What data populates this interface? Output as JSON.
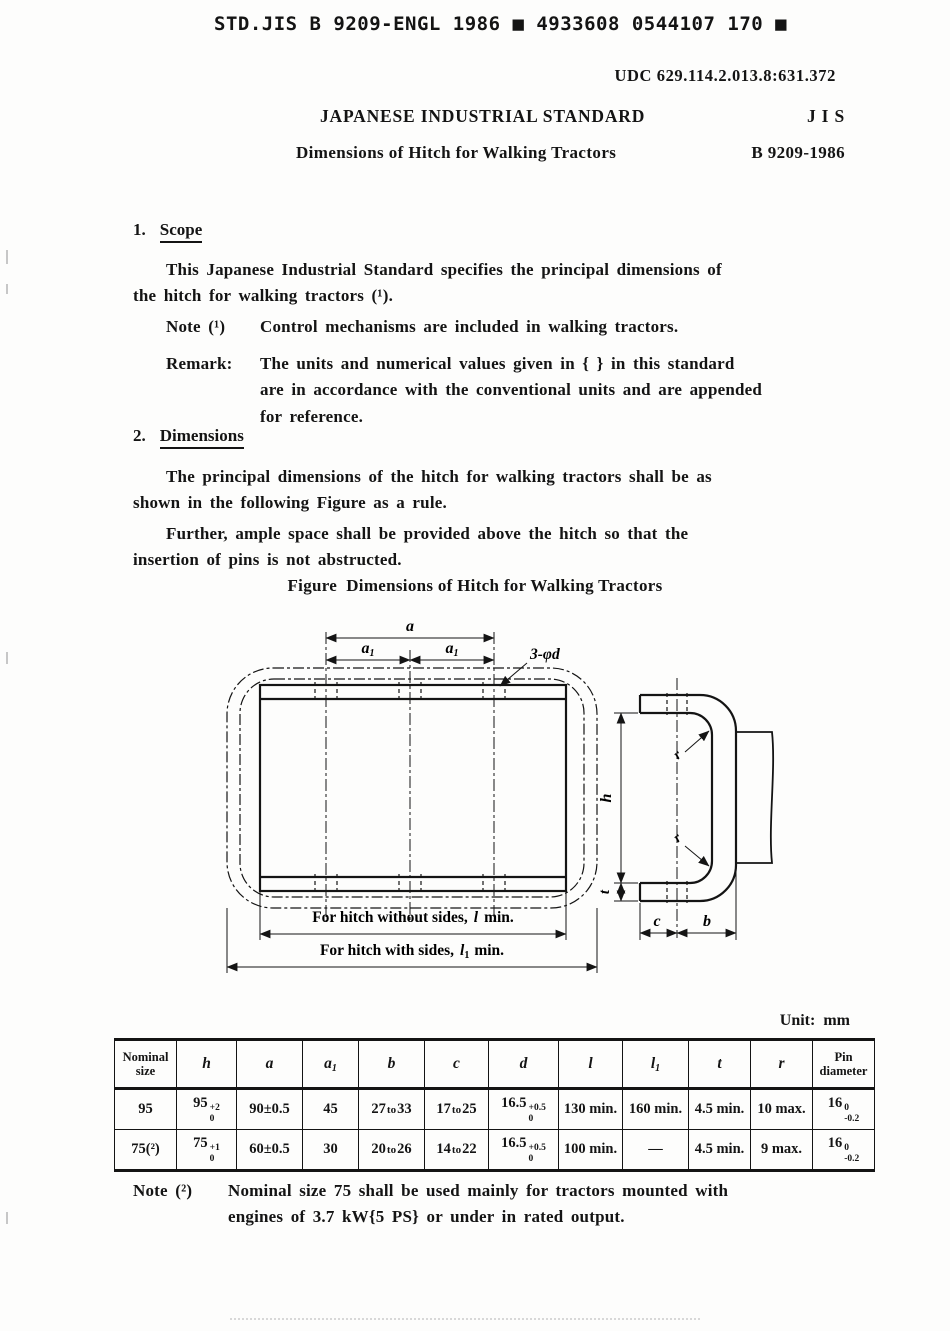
{
  "page": {
    "scan_header": "STD.JIS B 9209-ENGL 1986 ■ 4933608 0544107 170 ■",
    "udc": "UDC 629.114.2.013.8:631.372",
    "standard_title": "JAPANESE INDUSTRIAL STANDARD",
    "jis": "J I S",
    "doc_title": "Dimensions of Hitch for Walking Tractors",
    "doc_number": "B 9209-1986"
  },
  "scope": {
    "number": "1.",
    "heading": "Scope",
    "para": [
      "This Japanese Industrial Standard specifies the principal dimensions of",
      "the hitch for walking tractors (¹)."
    ],
    "note_label": "Note (¹)",
    "note_text": "Control mechanisms are included in walking tractors.",
    "remark_label": "Remark:",
    "remark": [
      "The units and numerical values given in { } in this standard",
      "are in accordance with the conventional units and are appended",
      "for reference."
    ]
  },
  "dims": {
    "number": "2.",
    "heading": "Dimensions",
    "para1": [
      "The principal dimensions of the hitch for walking tractors shall be as",
      "shown in the following Figure as a rule."
    ],
    "para2": [
      "Further, ample space shall be provided above the hitch so that the",
      "insertion of pins is not abstructed."
    ],
    "figure_caption": "Figure  Dimensions of Hitch for Walking Tractors"
  },
  "figure": {
    "a": "a",
    "a1_v": "a",
    "a1_s": "1",
    "holes": "3-φd",
    "h": "h",
    "t": "t",
    "c": "c",
    "b": "b",
    "r": "r",
    "l_pre": "For hitch without sides,",
    "l_sym": "l",
    "l_post": "min.",
    "l1_pre": "For hitch with sides,",
    "l1_sym": "l",
    "l1_sub": "1",
    "l1_post": "min."
  },
  "table": {
    "unit_label": "Unit:  mm",
    "headers": {
      "nominal": "Nominal\nsize",
      "h": "h",
      "a": "a",
      "a1v": "a",
      "a1s": "1",
      "b": "b",
      "c": "c",
      "d": "d",
      "l": "l",
      "l1v": "l",
      "l1s": "1",
      "t": "t",
      "r": "r",
      "pin": "Pin\ndiameter"
    },
    "rows": [
      {
        "nominal": "95",
        "h": {
          "v": "95",
          "sup": "+2",
          "sub": "0"
        },
        "a": "90±0.5",
        "a1": "45",
        "b": {
          "v1": "27",
          "to": "to",
          "v2": "33"
        },
        "c": {
          "v1": "17",
          "to": "to",
          "v2": "25"
        },
        "d": {
          "v": "16.5",
          "sup": "+0.5",
          "sub": "0"
        },
        "l": "130 min.",
        "l1": "160 min.",
        "t": "4.5 min.",
        "r": "10 max.",
        "pin": {
          "v": "16",
          "sup": "0",
          "sub": "-0.2"
        }
      },
      {
        "nominal": "75(²)",
        "h": {
          "v": "75",
          "sup": "+1",
          "sub": "0"
        },
        "a": "60±0.5",
        "a1": "30",
        "b": {
          "v1": "20",
          "to": "to",
          "v2": "26"
        },
        "c": {
          "v1": "14",
          "to": "to",
          "v2": "22"
        },
        "d": {
          "v": "16.5",
          "sup": "+0.5",
          "sub": "0"
        },
        "l": "100 min.",
        "l1": "—",
        "t": "4.5 min.",
        "r": "9 max.",
        "pin": {
          "v": "16",
          "sup": "0",
          "sub": "-0.2"
        }
      }
    ]
  },
  "note2": {
    "label": "Note (²)",
    "text": [
      "Nominal size 75 shall be used mainly for tractors mounted with",
      "engines of 3.7 kW{5 PS} or under in rated output."
    ]
  }
}
